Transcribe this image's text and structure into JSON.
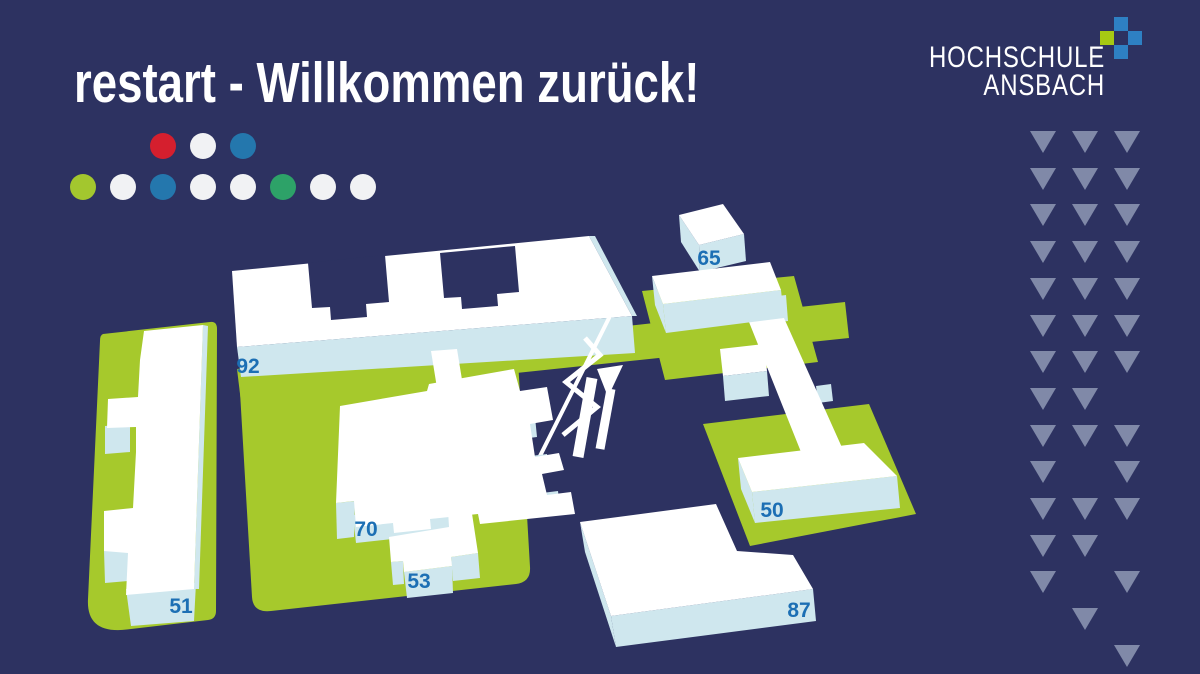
{
  "colors": {
    "bg": "#2d3261",
    "roof": "#ffffff",
    "side": "#cfe7ee",
    "ground": "#a6c92c",
    "label": "#1c6fb4",
    "tri": "#8089a8",
    "logo_blue": "#2e80c3",
    "logo_green": "#a6c913"
  },
  "header": {
    "title": "restart - Willkommen zurück!",
    "dots_row1": [
      "#d51f2e",
      "#f1f2f4",
      "#2477ad"
    ],
    "dots_row2": [
      "#a3c72e",
      "#f1f2f4",
      "#2477ad",
      "#f1f2f4",
      "#f1f2f4",
      "#2da268",
      "#f1f2f4",
      "#f1f2f4"
    ]
  },
  "logo": {
    "line1": "HOCHSCHULE",
    "line2": "ANSBACH"
  },
  "map": {
    "buildings": [
      {
        "number": "92"
      },
      {
        "number": "65"
      },
      {
        "number": "70"
      },
      {
        "number": "53"
      },
      {
        "number": "51"
      },
      {
        "number": "50"
      },
      {
        "number": "87"
      }
    ]
  },
  "decor": {
    "triangle_rows": [
      [
        1,
        1,
        1
      ],
      [
        1,
        1,
        1
      ],
      [
        1,
        1,
        1
      ],
      [
        1,
        1,
        1
      ],
      [
        1,
        1,
        1
      ],
      [
        1,
        1,
        1
      ],
      [
        1,
        1,
        1
      ],
      [
        1,
        1,
        0
      ],
      [
        1,
        1,
        1
      ],
      [
        1,
        0,
        1
      ],
      [
        1,
        1,
        1
      ],
      [
        1,
        1,
        0
      ],
      [
        1,
        0,
        1
      ],
      [
        0,
        1,
        0
      ],
      [
        0,
        0,
        1
      ]
    ]
  }
}
